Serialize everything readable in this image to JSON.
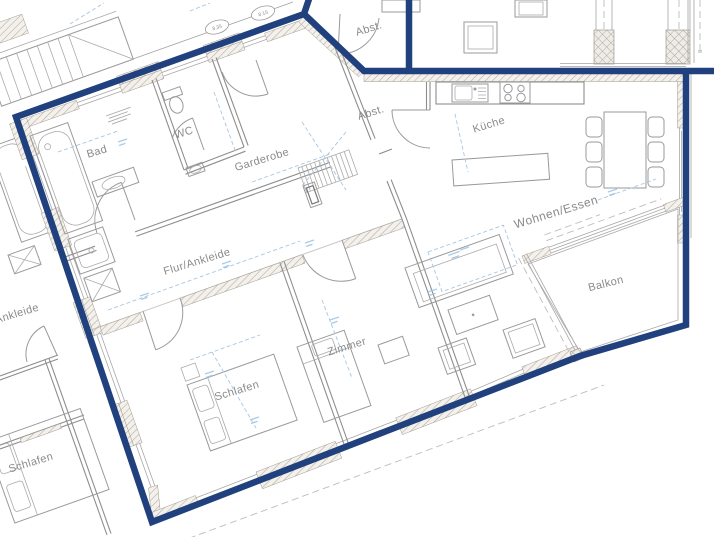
{
  "plan": {
    "rooms": [
      {
        "id": "bad",
        "label": "Bad"
      },
      {
        "id": "wc",
        "label": "WC"
      },
      {
        "id": "garderobe",
        "label": "Garderobe"
      },
      {
        "id": "abstellraum-top",
        "label": "Abst."
      },
      {
        "id": "abstellraum-kueche",
        "label": "Abst."
      },
      {
        "id": "kueche",
        "label": "Küche"
      },
      {
        "id": "wohnen-essen",
        "label": "Wohnen/Essen"
      },
      {
        "id": "balkon",
        "label": "Balkon"
      },
      {
        "id": "flur-ankleide",
        "label": "Flur/Ankleide"
      },
      {
        "id": "zimmer",
        "label": "Zimmer"
      },
      {
        "id": "schlafen",
        "label": "Schlafen"
      },
      {
        "id": "schlafen-neighbor",
        "label": "Schlafen"
      },
      {
        "id": "ankleide-neighbor",
        "label": "Ankleide"
      }
    ],
    "badges": [
      "8.35",
      "8.15"
    ],
    "wall_mark": "8",
    "colors": {
      "boundary": "#20407e",
      "walls": "#8e8e8e",
      "dimensions": "#a7c6e2",
      "labels": "#8a8a8a"
    }
  }
}
